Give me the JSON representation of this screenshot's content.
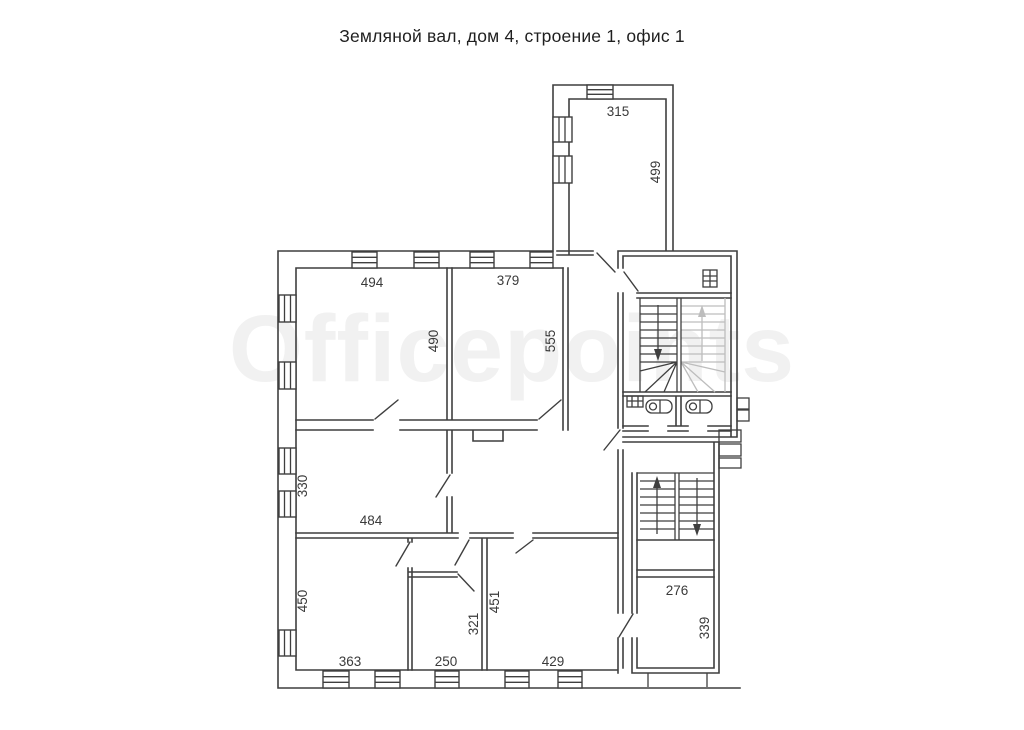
{
  "title": "Земляной вал, дом 4, строение 1, офис 1",
  "watermark": "Officepoints",
  "floor_plan": {
    "type": "floor-plan",
    "colors": {
      "line": "#3f3f3f",
      "light_stair": "#bdbdbd",
      "watermark": "#f1f1f1",
      "label_text": "#3a3a3a"
    },
    "dimension_labels": {
      "annex_top_width": "315",
      "annex_right_height": "499",
      "room_nw_width": "494",
      "room_nw_height": "490",
      "room_n_width": "379",
      "room_n_height": "555",
      "room_w_height": "330",
      "room_w_width": "484",
      "room_sw_height": "450",
      "room_sw_width": "363",
      "room_s_width": "250",
      "room_s_height": "321",
      "room_se_height": "451",
      "room_se_width": "429",
      "room_br_width": "276",
      "room_br_height": "339"
    }
  }
}
